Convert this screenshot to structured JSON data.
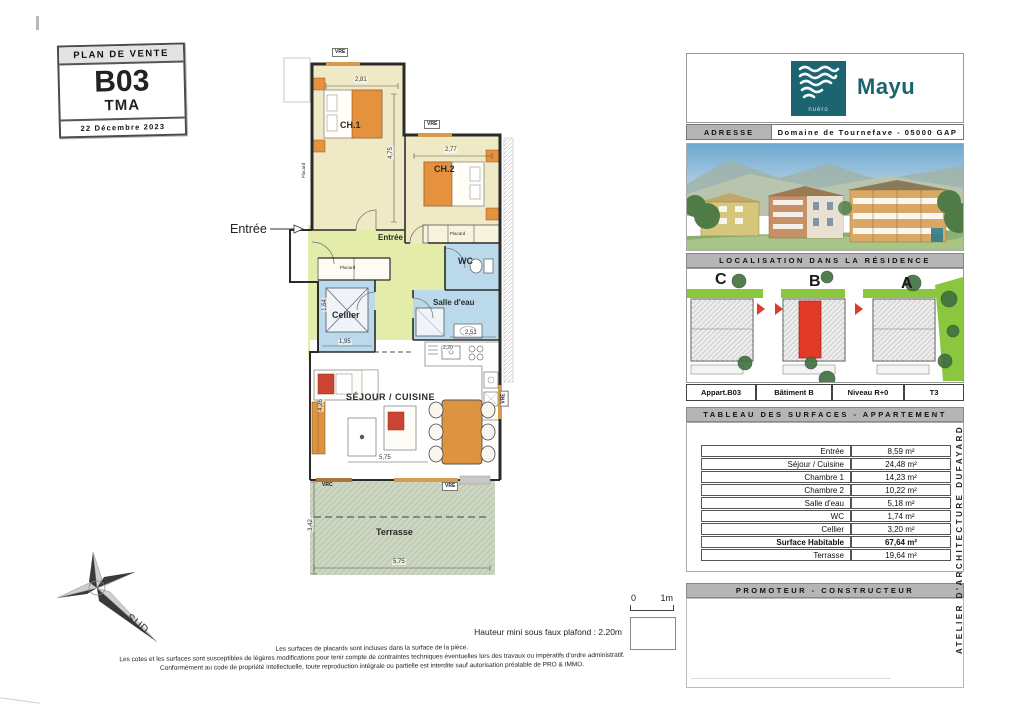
{
  "title_block": {
    "header": "PLAN DE VENTE",
    "unit": "B03",
    "variant": "TMA",
    "date": "22 Décembre 2023"
  },
  "plan": {
    "entrance_arrow_label": "Entrée",
    "rooms": {
      "ch1": "CH.1",
      "ch2": "CH.2",
      "entree": "Entrée",
      "wc": "WC",
      "salle_eau": "Salle d'eau",
      "cellier": "Cellier",
      "sejour": "SÉJOUR / CUISINE",
      "terrasse": "Terrasse"
    },
    "placard": "Placard",
    "windows": {
      "vre": "VRE",
      "vrc": "VRC"
    },
    "dims": {
      "ch1_w": "2,81",
      "ch1_h": "4,75",
      "ch2_w": "2,77",
      "cellier_w": "1,95",
      "cellier_h": "1,64",
      "salle_eau_w": "2,51",
      "kitchen_w": "2,20",
      "sejour_w": "5,75",
      "sejour_h": "4,26",
      "terrasse_h": "3,42",
      "terrasse_w": "5,75"
    }
  },
  "sidebar": {
    "logo": {
      "brand": "Mayu",
      "mark_caption": "nuèro"
    },
    "address": {
      "label": "ADRESSE",
      "value": "Domaine de Tournefave - 05000 GAP"
    },
    "localisation": {
      "header": "LOCALISATION DANS LA RÉSIDENCE",
      "buildings": [
        "C",
        "B",
        "A"
      ],
      "info": [
        "Appart.B03",
        "Bâtiment B",
        "Niveau R+0",
        "T3"
      ]
    },
    "surfaces": {
      "header": "TABLEAU DES SURFACES - APPARTEMENT",
      "rows": [
        {
          "label": "Entrée",
          "value": "8,59 m²"
        },
        {
          "label": "Séjour / Cuisine",
          "value": "24,48 m²"
        },
        {
          "label": "Chambre 1",
          "value": "14,23 m²"
        },
        {
          "label": "Chambre 2",
          "value": "10,22 m²"
        },
        {
          "label": "Salle d'eau",
          "value": "5,18 m²"
        },
        {
          "label": "WC",
          "value": "1,74 m²"
        },
        {
          "label": "Cellier",
          "value": "3,20 m²"
        },
        {
          "label": "Surface Habitable",
          "value": "67,64 m²"
        },
        {
          "label": "Terrasse",
          "value": "19,64 m²"
        }
      ]
    },
    "promoter_header": "PROMOTEUR - CONSTRUCTEUR",
    "architect_sideline": "ATELIER D'ARCHITECTURE DUFAYARD"
  },
  "footer": {
    "scale": {
      "zero": "0",
      "one": "1m"
    },
    "height_note": "Hauteur mini sous faux plafond : 2.20m",
    "notes": [
      "Les surfaces de placards sont incluses dans la surface de la pièce.",
      "Les cotes et les surfaces sont susceptibles de légères modifications pour tenir compte de contraintes techniques éventuelles lors des travaux ou impératifs d'ordre administratif.",
      "Conformément au code de propriété intellectuelle, toute reproduction intégrale ou partielle est interdite sauf autorisation préalable de PRO & IMMO."
    ],
    "compass_label": "SUD"
  },
  "colors": {
    "accent_teal": "#1c646f",
    "unit_red": "#e33226",
    "site_green": "#8bc63f",
    "room_beige": "#f0e9c6",
    "room_green": "#e4ecaa",
    "room_blue": "#badaeb",
    "terrace_green": "#ccd6c0",
    "window_orange": "#d89a4e",
    "bar_gray": "#b5b5b5"
  }
}
